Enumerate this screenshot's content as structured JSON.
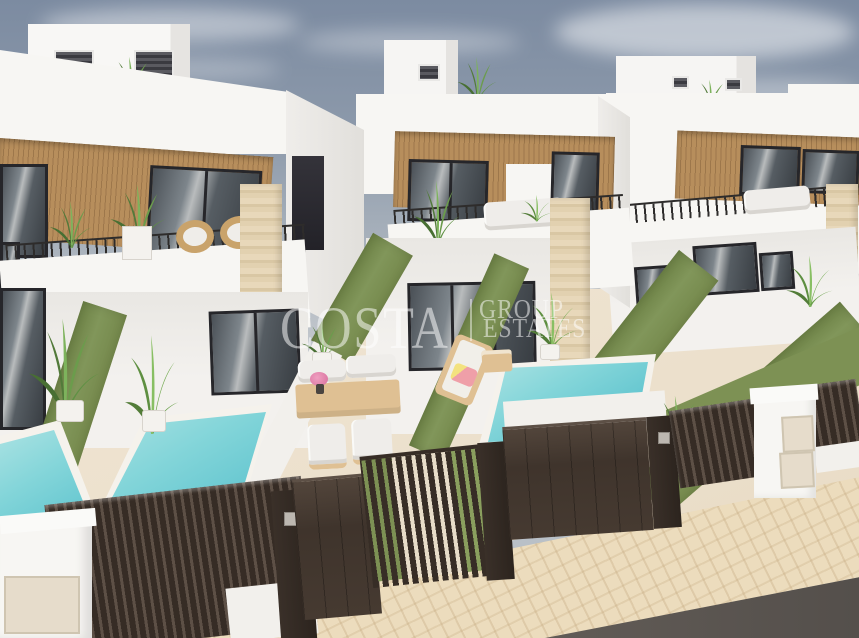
{
  "meta": {
    "kind": "3d-architectural-exterior-render",
    "subject": "Row of modern white two-storey townhouse villas with private pools, seen from an elevated street corner view"
  },
  "watermark": {
    "brand": "COSTA",
    "word_group": "GROUP",
    "word_estates": "ESTATES",
    "color": "rgba(255,255,255,0.52)"
  },
  "scene": {
    "sky": {
      "top_color": "#7c8ba1",
      "horizon_color": "#c6cacf",
      "clouds": "thin white streaks"
    },
    "villas": [
      {
        "id": "villa-1",
        "position": "front-left",
        "features": [
          "rooftop access box with louvre vents and plant",
          "wood-slat upper facade with dark framed windows",
          "balcony with black bar railing, rattan chairs and plants",
          "travertine pillar",
          "ground-floor sliding glass door",
          "terrace with outdoor dining set",
          "private pool"
        ]
      },
      {
        "id": "villa-2",
        "position": "center",
        "features": [
          "rooftop box and roof plant",
          "wood-slat band with windows",
          "L-shaped balcony with white sofa and plants",
          "travertine pillar with palm",
          "glass ground floor",
          "sun lounger with pink towel and side table",
          "private pool"
        ]
      },
      {
        "id": "villa-3",
        "position": "right",
        "features": [
          "rooftop box with plant",
          "wood-slat band with windows",
          "balcony with white sofa",
          "travertine pillar",
          "front lawn",
          "palm tree"
        ]
      },
      {
        "id": "building-4",
        "position": "far-right background"
      }
    ],
    "site": [
      "green artificial-grass privacy walls between plots",
      "dark brown aluminium slatted fences, solid driveway gates with keypads and see-through slatted pedestrian gates",
      "white utility / meter cabinets",
      "beige brick-paved sidewalk",
      "dark asphalt road in bottom-right corner",
      "turquoise pools with white coping"
    ],
    "materials": {
      "facade_white": "#f7f6f3",
      "facade_shade": "#e1dfdb",
      "wood_slats": "#b78e5c",
      "window_frame": "#26262a",
      "glass": "#5c646b",
      "green_wall": "#7d9154",
      "pool_water": "#7fd4d8",
      "travertine": "#e3d2b0",
      "terrace_paving": "#ece0cc",
      "sidewalk": "#ecdcbd",
      "road": "#5a5450",
      "fence_gate": "#3f342c",
      "furniture_wood": "#dfc093",
      "cushions": "#efedea",
      "towel_pink": "#f0a0a8"
    }
  }
}
